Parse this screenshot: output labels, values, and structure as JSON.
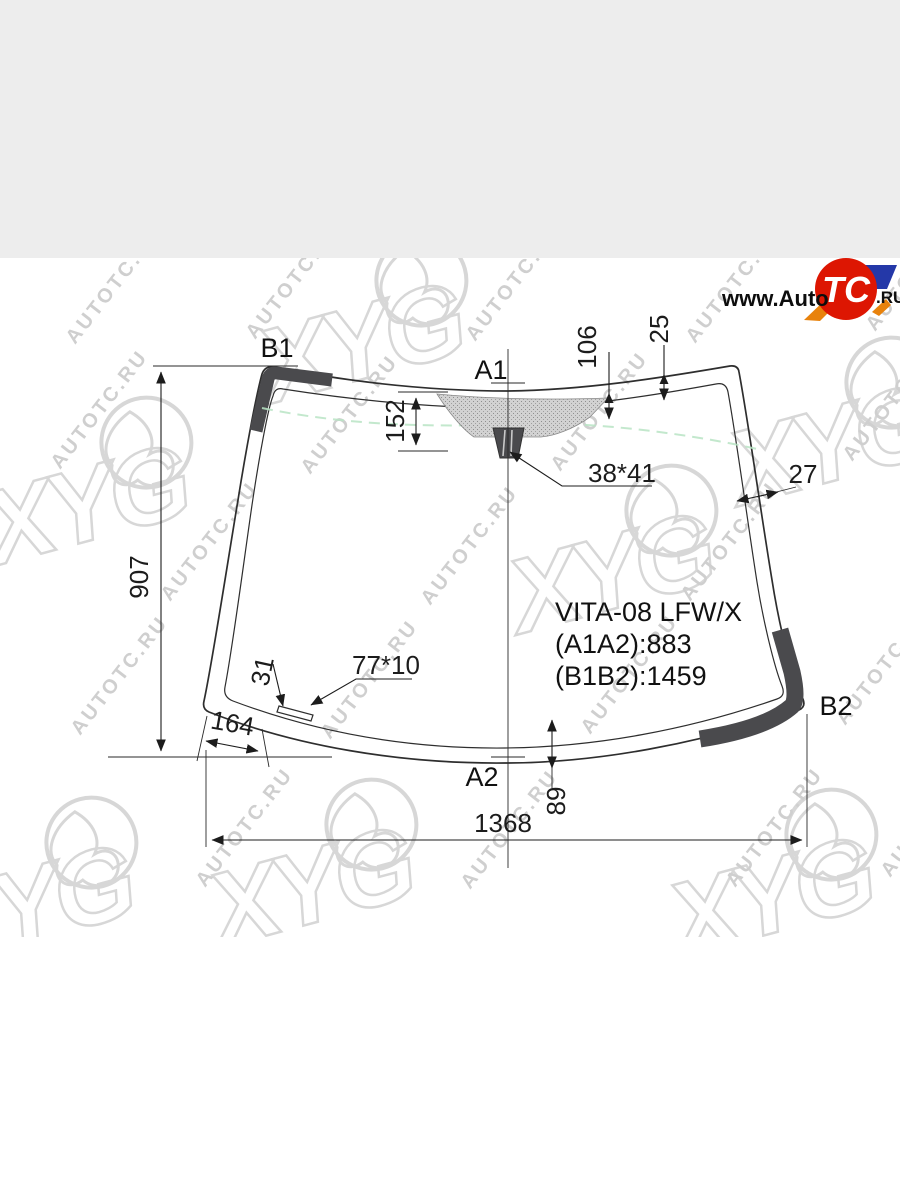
{
  "page": {
    "top_band_color": "#ededed",
    "content_bg": "#ffffff"
  },
  "logo": {
    "www_prefix": "www.Auto",
    "tc": "TC",
    "ru_suffix": ".RU",
    "red": "#dd1602",
    "blue": "#2438a8",
    "orange": "#e8820c"
  },
  "watermark": {
    "text": "AUTOTC.RU",
    "brand": "XYG",
    "color": "#d7d7d7"
  },
  "diagram": {
    "part_code": "VITA-08 LFW/X",
    "dim_a1a2": "(A1A2):883",
    "dim_b1b2": "(B1B2):1459",
    "labels": {
      "b1": "B1",
      "a1": "A1",
      "b2": "B2",
      "a2": "A2"
    },
    "dimensions": {
      "height_left": "907",
      "width_bottom": "1368",
      "frit_left": "152",
      "frit_center": "106",
      "frit_right": "25",
      "edge_right": "27",
      "mirror_mount": "38*41",
      "strip_size": "77*10",
      "strip_offset": "31",
      "corner_offset": "164",
      "bottom_offset": "89"
    },
    "colors": {
      "line": "#2e2e2e",
      "corner_fill": "#4a4a4d",
      "frit_fill": "#d2d2d2",
      "green_line": "#b9e4c4"
    }
  }
}
